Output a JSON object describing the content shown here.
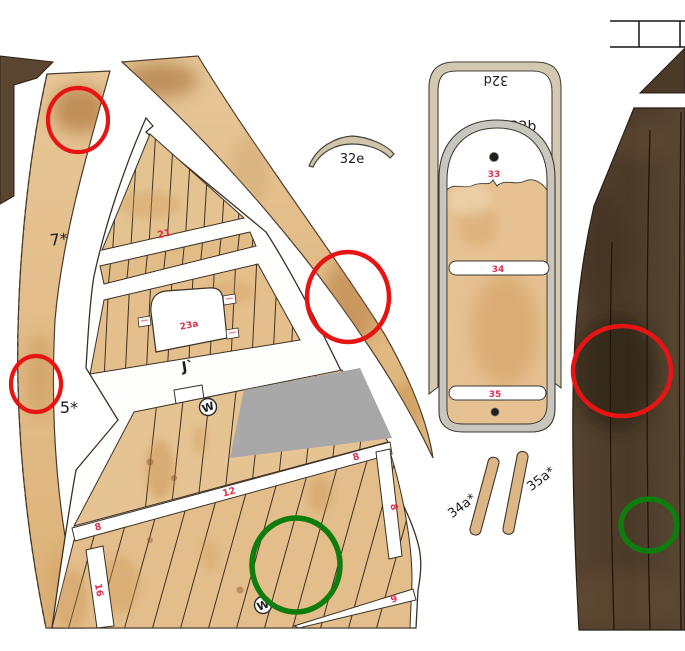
{
  "sheet": {
    "labels": {
      "deck_part_top": "7*",
      "deck_part_bottom": "5*",
      "deck_j_mark": "J`",
      "strip_21": "21",
      "arch_23a": "23a",
      "strip_8_left": "8",
      "strip_12": "12",
      "strip_8_right": "8",
      "strip_8_seam": "8",
      "strip_16": "16",
      "strip_9": "9",
      "wood_mark_upper": "W",
      "wood_mark_lower": "W",
      "arc_32e": "32e",
      "frame_32d": "32d",
      "grain_symbol": "∩",
      "floor_32b": "32b",
      "hole_33": "33",
      "brace_34": "34",
      "brace_35": "35",
      "strip_34a": "34a*",
      "strip_35a": "35a*"
    },
    "annotations": {
      "red_circle_count": 4,
      "green_circle_count": 2,
      "red_color": "#e81414",
      "green_color": "#0e7c0e"
    },
    "palette": {
      "plank_wood": "#e4bf8b",
      "dark_hull_wood": "#4c3a29",
      "part_beige": "#d2c8b1",
      "gray_block": "#a8a8a8",
      "label_red": "#e0304e",
      "outline": "#3b3126"
    }
  }
}
